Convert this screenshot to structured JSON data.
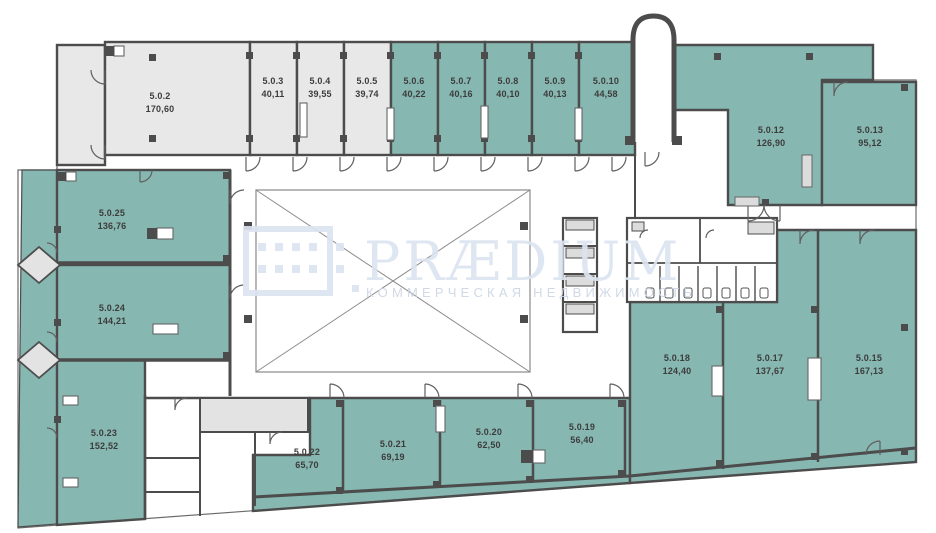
{
  "watermark": {
    "brand": "PRÆDIUM",
    "tagline": "КОММЕРЧЕСКАЯ НЕДВИЖИМОСТЬ"
  },
  "colors": {
    "available_fill": "#87b7b1",
    "secondary_fill": "#e8e8e8",
    "wall": "#4c4c4c",
    "watermark": "#dce4f0"
  },
  "rooms": [
    {
      "code": "5.0.2",
      "area": "170,60",
      "x": 160,
      "y": 99,
      "status": "secondary"
    },
    {
      "code": "5.0.3",
      "area": "40,11",
      "x": 273,
      "y": 84,
      "status": "secondary"
    },
    {
      "code": "5.0.4",
      "area": "39,55",
      "x": 320,
      "y": 84,
      "status": "secondary"
    },
    {
      "code": "5.0.5",
      "area": "39,74",
      "x": 367,
      "y": 84,
      "status": "secondary"
    },
    {
      "code": "5.0.6",
      "area": "40,22",
      "x": 414,
      "y": 84,
      "status": "available"
    },
    {
      "code": "5.0.7",
      "area": "40,16",
      "x": 461,
      "y": 84,
      "status": "available"
    },
    {
      "code": "5.0.8",
      "area": "40,10",
      "x": 508,
      "y": 84,
      "status": "available"
    },
    {
      "code": "5.0.9",
      "area": "40,13",
      "x": 555,
      "y": 84,
      "status": "available"
    },
    {
      "code": "5.0.10",
      "area": "44,58",
      "x": 606,
      "y": 84,
      "status": "available"
    },
    {
      "code": "5.0.12",
      "area": "126,90",
      "x": 771,
      "y": 133,
      "status": "available"
    },
    {
      "code": "5.0.13",
      "area": "95,12",
      "x": 870,
      "y": 133,
      "status": "available"
    },
    {
      "code": "5.0.25",
      "area": "136,76",
      "x": 112,
      "y": 216,
      "status": "available"
    },
    {
      "code": "5.0.24",
      "area": "144,21",
      "x": 112,
      "y": 311,
      "status": "available"
    },
    {
      "code": "5.0.23",
      "area": "152,52",
      "x": 104,
      "y": 436,
      "status": "available"
    },
    {
      "code": "5.0.22",
      "area": "65,70",
      "x": 307,
      "y": 455,
      "status": "available"
    },
    {
      "code": "5.0.21",
      "area": "69,19",
      "x": 393,
      "y": 447,
      "status": "available"
    },
    {
      "code": "5.0.20",
      "area": "62,50",
      "x": 489,
      "y": 435,
      "status": "available"
    },
    {
      "code": "5.0.19",
      "area": "56,40",
      "x": 582,
      "y": 430,
      "status": "available"
    },
    {
      "code": "5.0.18",
      "area": "124,40",
      "x": 677,
      "y": 361,
      "status": "available"
    },
    {
      "code": "5.0.17",
      "area": "137,67",
      "x": 770,
      "y": 361,
      "status": "available"
    },
    {
      "code": "5.0.15",
      "area": "167,13",
      "x": 869,
      "y": 361,
      "status": "available"
    }
  ]
}
